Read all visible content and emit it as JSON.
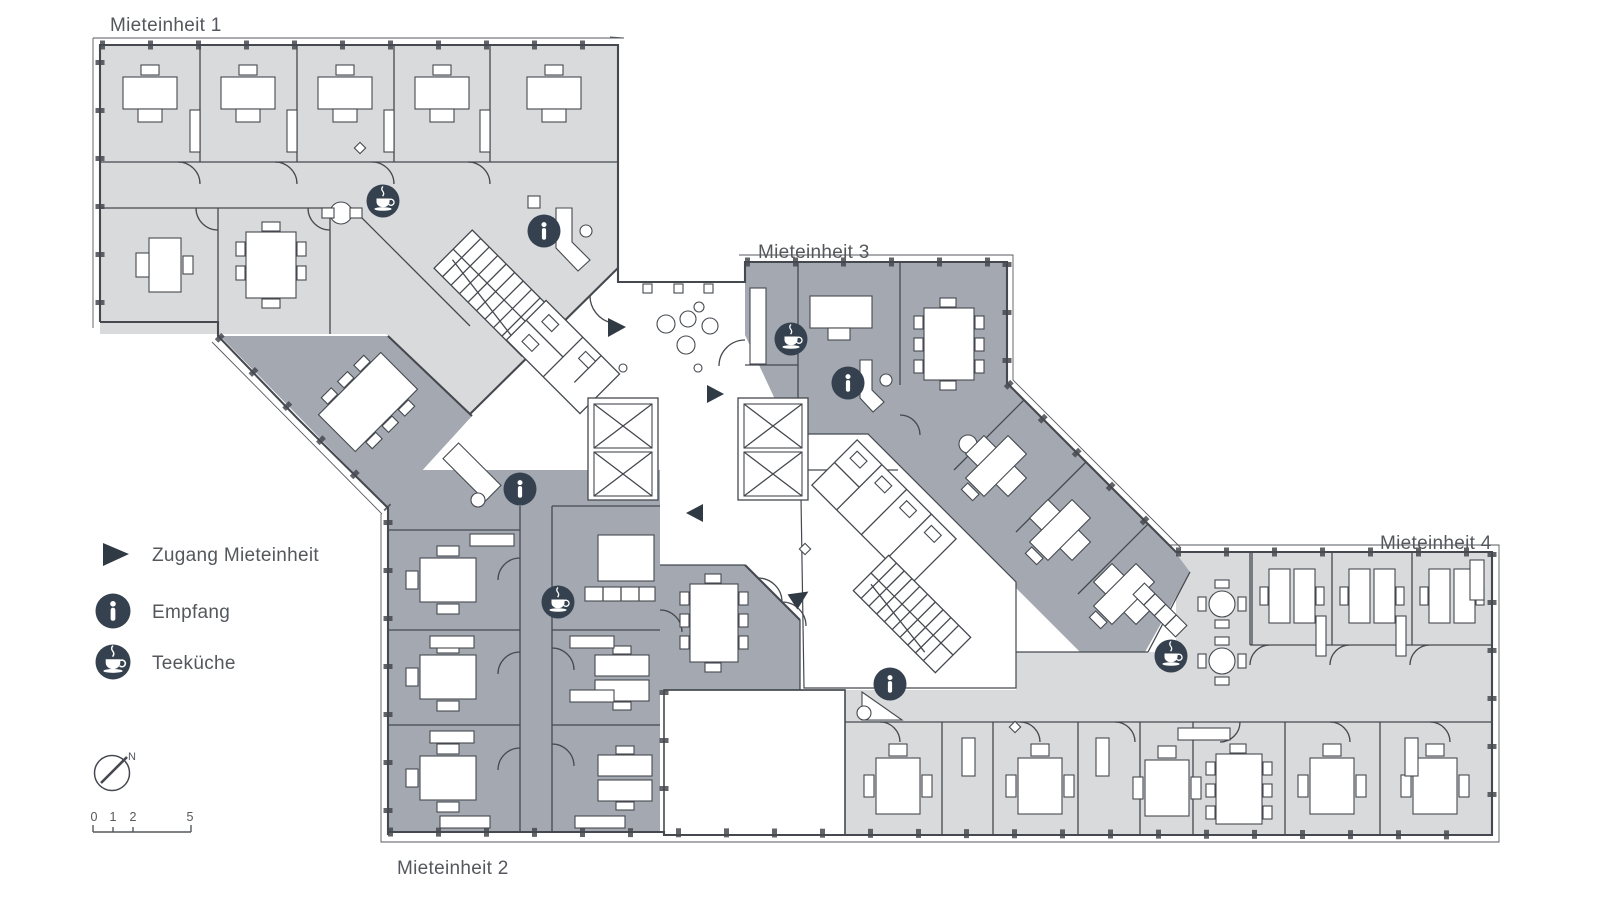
{
  "page": {
    "background": "#ffffff"
  },
  "plan": {
    "type": "floorplan",
    "units": [
      {
        "id": 1,
        "label": "Mieteinheit 1",
        "shade": "light"
      },
      {
        "id": 2,
        "label": "Mieteinheit 2",
        "shade": "dark"
      },
      {
        "id": 3,
        "label": "Mieteinheit 3",
        "shade": "dark"
      },
      {
        "id": 4,
        "label": "Mieteinheit 4",
        "shade": "light"
      }
    ],
    "markers": [
      {
        "icon": "teacup-icon",
        "meaning": "Teeküche",
        "unit": 1
      },
      {
        "icon": "info-icon",
        "meaning": "Empfang",
        "unit": 1
      },
      {
        "icon": "teacup-icon",
        "meaning": "Teeküche",
        "unit": 2
      },
      {
        "icon": "info-icon",
        "meaning": "Empfang",
        "unit": 2
      },
      {
        "icon": "teacup-icon",
        "meaning": "Teeküche",
        "unit": 3
      },
      {
        "icon": "info-icon",
        "meaning": "Empfang",
        "unit": 3
      },
      {
        "icon": "teacup-icon",
        "meaning": "Teeküche",
        "unit": 4
      },
      {
        "icon": "info-icon",
        "meaning": "Empfang",
        "unit": 4
      },
      {
        "icon": "entrance-arrow-icon",
        "meaning": "Zugang Mieteinheit",
        "count": 4
      }
    ]
  },
  "legend": {
    "items": [
      {
        "icon": "entrance-arrow-icon",
        "label": "Zugang Mieteinheit"
      },
      {
        "icon": "info-icon",
        "label": "Empfang"
      },
      {
        "icon": "teacup-icon",
        "label": "Teeküche"
      }
    ],
    "compass": {
      "icon": "north-compass-icon",
      "label": "N"
    },
    "scale_bar": {
      "ticks": [
        "0",
        "1",
        "2",
        "5"
      ]
    }
  },
  "colors": {
    "unit_light": "#d9dadc",
    "unit_dark": "#a3a8b1",
    "wall": "#45494f",
    "icon_bg": "#35414e",
    "label_text": "#54585d",
    "background": "#ffffff"
  }
}
